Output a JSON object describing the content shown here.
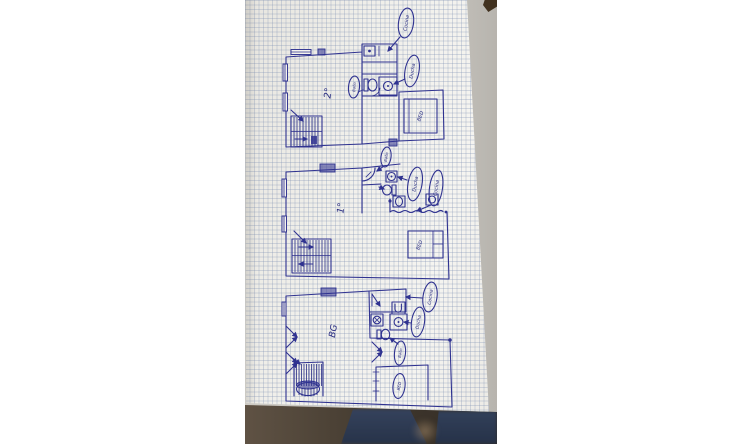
{
  "colors": {
    "ink": "#2f3290",
    "ink_dark": "#262a7c",
    "paper": "#f2f1ec",
    "grid_line": "#7d8fb2",
    "photo_background": "#c6c3bd",
    "table_corner": "#41311f",
    "floor_shadow": "#3c342b",
    "jeans": "#2d3a54"
  },
  "sketch": {
    "floors": [
      {
        "id": "second-floor",
        "floor_label": "2°",
        "labels": {
          "kitchen": "Cocina",
          "bathroom": "Baño",
          "shower": "Ducha",
          "bed": "BED"
        }
      },
      {
        "id": "first-floor",
        "floor_label": "1°",
        "labels": {
          "bathroom": "Baño",
          "shower": "Ducha",
          "kitchen": "Cocina",
          "bed": "BED"
        }
      },
      {
        "id": "ground-floor",
        "floor_label": "BG",
        "labels": {
          "kitchen": "Cocina",
          "shower": "Ducha",
          "bathroom": "Baño",
          "bed": "BED"
        }
      }
    ]
  }
}
